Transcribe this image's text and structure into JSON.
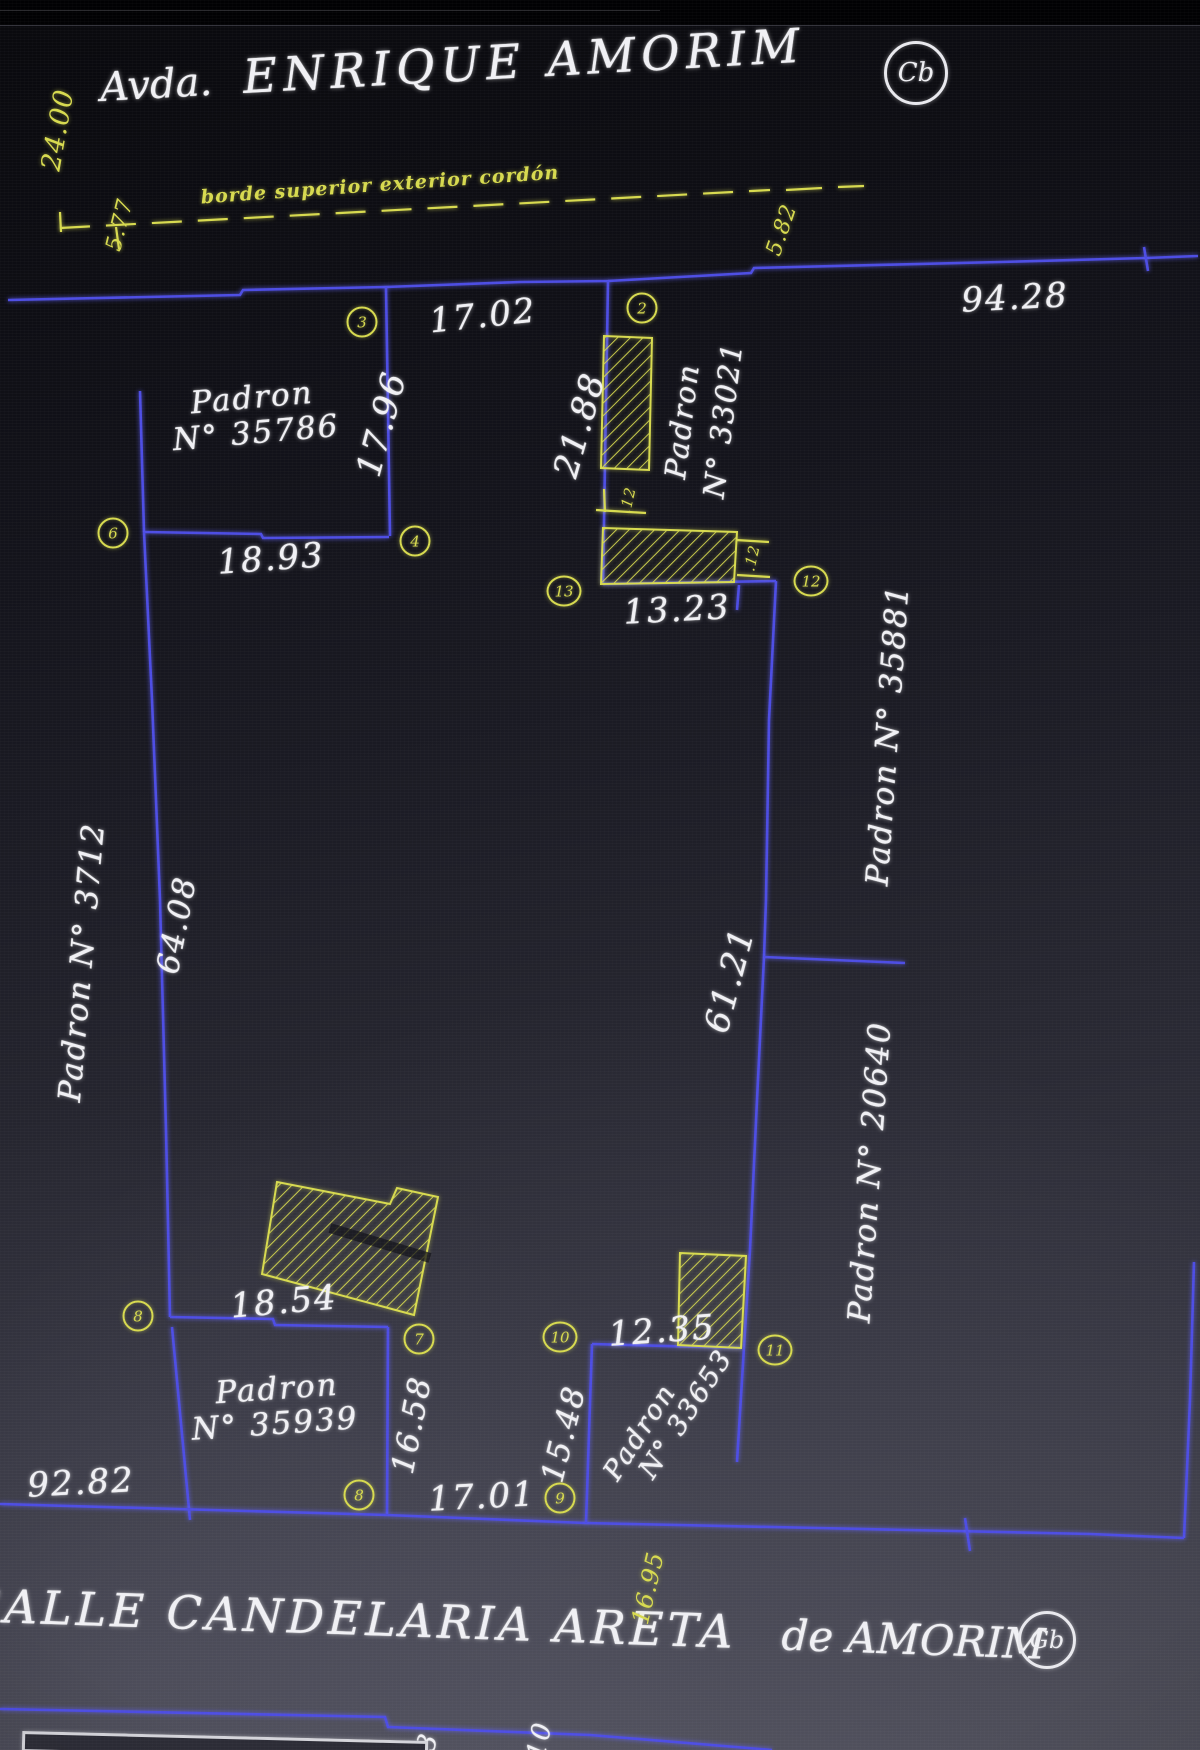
{
  "title": {
    "prefix": "Avda.",
    "name": "ENRIQUE AMORIM",
    "ref_circle": "Cb"
  },
  "bottom_street": {
    "name": "CALLE CANDELARIA ARETA",
    "suffix": "de AMORIM",
    "ref_circle": "Gb"
  },
  "curb_note": "borde superior exterior cordón",
  "parcels": {
    "p35786": {
      "line1": "Padron",
      "line2": "N° 35786"
    },
    "p33021": {
      "line1": "Padron",
      "line2": "N° 33021"
    },
    "p35881": {
      "label": "Padron N° 35881"
    },
    "p3712": {
      "label": "Padron N° 3712"
    },
    "p20640": {
      "label": "Padron N° 20640"
    },
    "p35939": {
      "line1": "Padron",
      "line2": "N° 35939"
    },
    "p33653": {
      "line1": "Padron",
      "line2": "N° 33653"
    }
  },
  "dimensions": {
    "street_width_top": "24.00",
    "offset_left": "5.77",
    "offset_right": "5.82",
    "front_total": "94.28",
    "front_17_02": "17.02",
    "side_17_96": "17.96",
    "side_21_88": "21.88",
    "back_18_93": "18.93",
    "strip_13_23": "13.23",
    "strip_tick_a": ".12",
    "strip_tick_b": ".12",
    "left_64_08": "64.08",
    "mid_61_21": "61.21",
    "build_18_54": "18.54",
    "gap_12_35": "12.35",
    "side_16_58": "16.58",
    "side_15_48": "15.48",
    "front_17_01": "17.01",
    "front_92_82": "92.82",
    "curb_16_95": "16.95",
    "partial_a": "3",
    "partial_b": "10"
  },
  "vertices": {
    "v2": "2",
    "v3": "3",
    "v4": "4",
    "v6": "6",
    "v7": "7",
    "v8_left": "8",
    "v8_bottom": "8",
    "v9": "9",
    "v10": "10",
    "v11": "11",
    "v12": "12",
    "v13": "13"
  },
  "colors": {
    "line_blue": "#4d4de4",
    "cad_yellow": "#d7da4f",
    "text_white": "#f0f0f4"
  }
}
